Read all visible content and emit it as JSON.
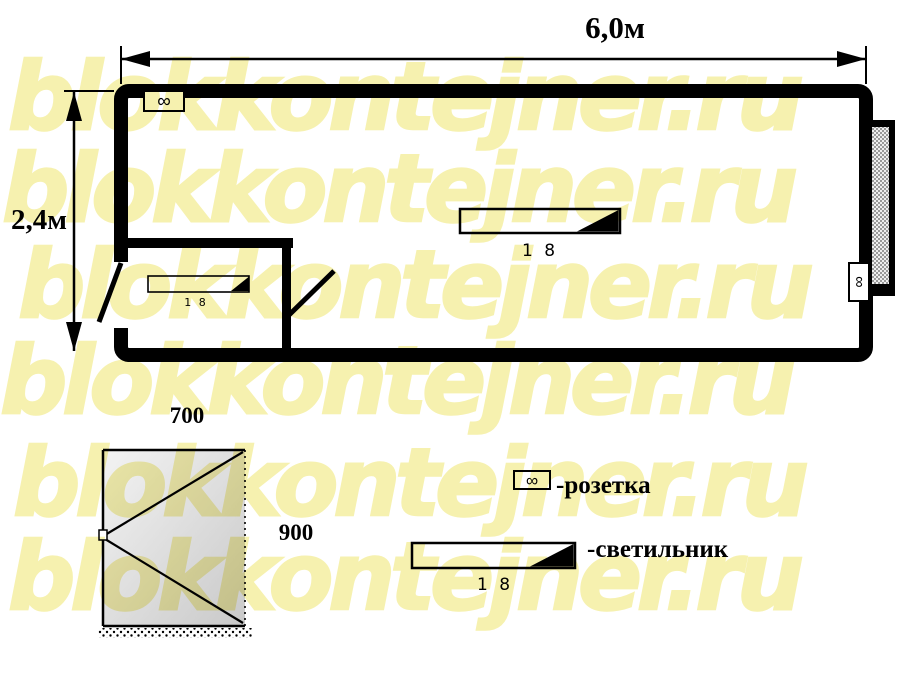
{
  "watermark": {
    "text": "blokkontejner.ru",
    "color": "#f6f1af"
  },
  "plan": {
    "width_label": "6,0м",
    "height_label": "2,4м",
    "main_light_label": "1 8",
    "small_room_light_label": "1 8",
    "outlet_symbol": "∞"
  },
  "door_detail": {
    "width_label": "700",
    "height_label": "900"
  },
  "legend": {
    "outlet_symbol": "∞",
    "outlet_label": "-розетка",
    "light_value": "1 8",
    "light_label": "-светильник"
  },
  "colors": {
    "line": "#000000",
    "watermark": "#f6f1af",
    "window_hatch": "#9a9a9a"
  }
}
